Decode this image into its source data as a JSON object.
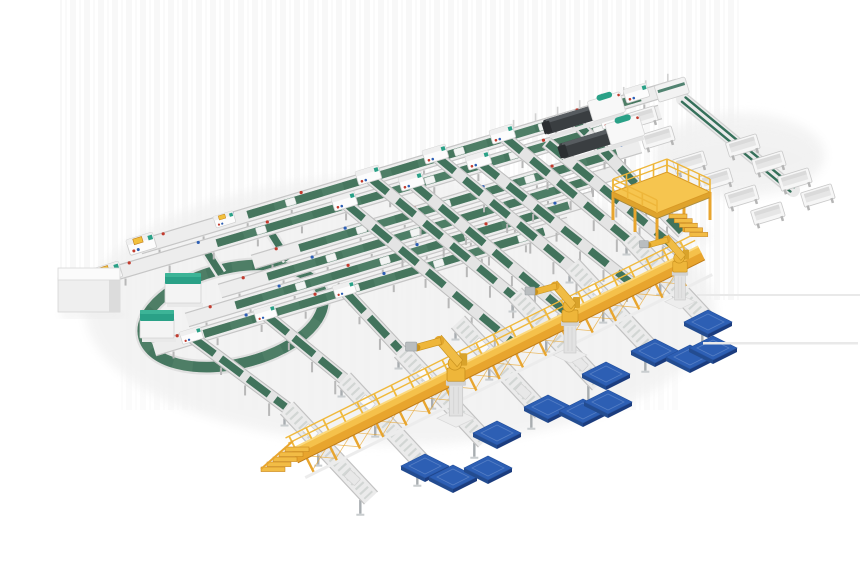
{
  "meta": {
    "scene_title": "Automated conveyor sortation and robotic palletizing line – 3D render",
    "canvas": {
      "width": 860,
      "height": 580
    }
  },
  "palette": {
    "bg": "#ffffff",
    "streak": "#000000",
    "frame": "#ededed",
    "frame_edge": "#c6c6c6",
    "leg": "#b8b8b8",
    "leg_dark": "#a8adb0",
    "green": "#4e7e66",
    "green_dark": "#3f6f58",
    "green2": "#41735c",
    "loop_green": "#35705a",
    "teal": "#2aa187",
    "teal_light": "#3cb497",
    "yellow": "#f5c14b",
    "yellow_mid": "#e8a52e",
    "yellow_deep": "#c07c17",
    "yellow_lip": "#fbd97e",
    "robot_yellow": "#eeb63a",
    "robot_edge": "#c9921f",
    "blue_top": "#2d5fb4",
    "blue_bevel": "#5e86c8",
    "blue_side": "#1b3c7e",
    "blue_side2": "#234c90",
    "dark_machine": "#3a3e41",
    "dark_ridge": "#575c60",
    "dark_tip": "#2b2e31",
    "white_part": "#f8f8f8",
    "dot_red": "#c23b2e",
    "dot_blue": "#2d5fb4",
    "shadow": "#f1f1f1",
    "floor_line": "#e9e9e9"
  },
  "scene": {
    "a_lines": [
      [
        140,
        247,
        678,
        86,
        0.2,
        0.93
      ],
      [
        106,
        276,
        660,
        112,
        0.2,
        0.93
      ],
      [
        253,
        262,
        640,
        146,
        0.12,
        0.94
      ],
      [
        220,
        291,
        617,
        172,
        0.12,
        0.94
      ],
      [
        187,
        320,
        593,
        198,
        0.12,
        0.94
      ],
      [
        154,
        349,
        569,
        224,
        0.12,
        0.94
      ]
    ],
    "hoods": [
      {
        "x": 369,
        "y": 177,
        "s": 1
      },
      {
        "x": 436,
        "y": 156,
        "s": 1
      },
      {
        "x": 503,
        "y": 136,
        "s": 1
      },
      {
        "x": 637,
        "y": 95,
        "s": 1
      },
      {
        "x": 345,
        "y": 203,
        "s": 1
      },
      {
        "x": 412,
        "y": 183,
        "s": 1
      },
      {
        "x": 479,
        "y": 162,
        "s": 1
      },
      {
        "x": 613,
        "y": 121,
        "s": 1
      },
      {
        "x": 192,
        "y": 337,
        "s": 0.9
      },
      {
        "x": 266,
        "y": 315,
        "s": 0.9
      },
      {
        "x": 345,
        "y": 291,
        "s": 0.9
      }
    ],
    "stubs": [
      {
        "x": 142,
        "y": 246
      },
      {
        "x": 108,
        "y": 275
      }
    ],
    "yellow_tick": {
      "x": 225,
      "y": 221
    },
    "lanes": [
      [
        369,
        177,
        529,
        309
      ],
      [
        345,
        203,
        522,
        350
      ],
      [
        436,
        156,
        586,
        280
      ],
      [
        412,
        183,
        579,
        323
      ],
      [
        503,
        136,
        643,
        252
      ],
      [
        479,
        162,
        646,
        295
      ],
      [
        570,
        116,
        683,
        233
      ],
      [
        546,
        142,
        693,
        262
      ]
    ],
    "short_lanes": [
      [
        192,
        337,
        287,
        408
      ],
      [
        266,
        315,
        344,
        379
      ],
      [
        345,
        291,
        401,
        351
      ]
    ],
    "rollers": [
      [
        287,
        408,
        371,
        498
      ],
      [
        344,
        379,
        428,
        469
      ],
      [
        401,
        351,
        485,
        441
      ],
      [
        458,
        322,
        542,
        412
      ],
      [
        515,
        294,
        599,
        384
      ],
      [
        572,
        265,
        656,
        355
      ],
      [
        629,
        237,
        713,
        327
      ]
    ],
    "packages_up": [
      [
        310,
        432
      ],
      [
        367,
        403
      ],
      [
        424,
        375
      ],
      [
        481,
        346
      ],
      [
        595,
        289
      ]
    ],
    "packages_low": [
      [
        352,
        478
      ],
      [
        523,
        392
      ],
      [
        580,
        364
      ]
    ],
    "walkway": [
      293,
      453,
      700,
      250
    ],
    "stairs": {
      "x": 295,
      "y": 449
    },
    "platform": {
      "cx": 660,
      "cy": 192
    },
    "machines": [
      {
        "x": 545,
        "y": 128,
        "s": 1
      },
      {
        "x": 561,
        "y": 152,
        "s": 1.04
      }
    ],
    "bin_loop": [
      683,
      99,
      793,
      190
    ],
    "corner": {
      "x": 672,
      "y": 90
    },
    "bins": [
      [
        690,
        163
      ],
      [
        716,
        180
      ],
      [
        742,
        197
      ],
      [
        768,
        214
      ],
      [
        743,
        146
      ],
      [
        769,
        163
      ],
      [
        795,
        180
      ],
      [
        818,
        196
      ],
      [
        641,
        118
      ],
      [
        658,
        138
      ]
    ],
    "rail_posts": {
      "line": 0,
      "u0": 392,
      "u1": 560,
      "step": 23
    },
    "ring": {
      "cx": 233,
      "cy": 316,
      "rx": 92,
      "ry": 48,
      "rot": -13
    },
    "ring_belts": [
      [
        203,
        246,
        221,
        274
      ],
      [
        268,
        228,
        288,
        260
      ]
    ],
    "teal_boxes": [
      [
        165,
        273,
        36,
        30
      ],
      [
        140,
        310,
        34,
        28
      ]
    ],
    "cabinet": {
      "x": 58,
      "y": 268,
      "w": 62,
      "h": 44
    },
    "robots": [
      {
        "x": 456,
        "y": 416,
        "s": 1.12
      },
      {
        "x": 570,
        "y": 353,
        "s": 1.0
      },
      {
        "x": 680,
        "y": 300,
        "s": 0.9
      }
    ],
    "pallets": [
      [
        425,
        466
      ],
      [
        453,
        477
      ],
      [
        488,
        468
      ],
      [
        497,
        433
      ],
      [
        548,
        407
      ],
      [
        583,
        411
      ],
      [
        608,
        402
      ],
      [
        606,
        374
      ],
      [
        655,
        351
      ],
      [
        690,
        357
      ],
      [
        713,
        348
      ],
      [
        708,
        322
      ]
    ],
    "floor_lines": [
      [
        697,
        294,
        163,
        2
      ],
      [
        703,
        342,
        155,
        2.5
      ]
    ],
    "soft_shadows": [
      [
        400,
        310,
        315,
        135
      ],
      [
        740,
        155,
        85,
        42
      ],
      [
        660,
        236,
        52,
        9
      ]
    ]
  }
}
